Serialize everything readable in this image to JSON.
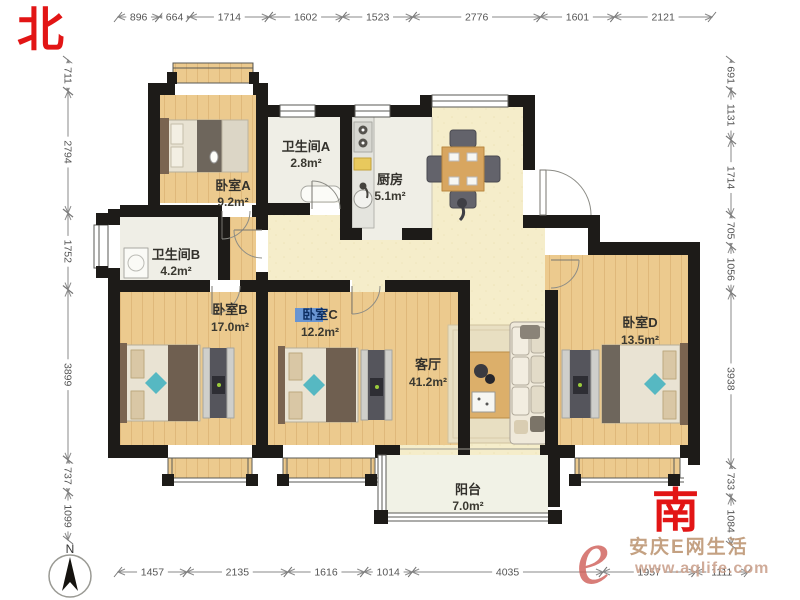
{
  "directions": {
    "north": "北",
    "south": "南"
  },
  "compass": {
    "label": "N"
  },
  "watermark": {
    "logo": "e",
    "site_name": "安庆E网生活",
    "url": "www.aqlife.com"
  },
  "rooms": {
    "bedroomA": {
      "name": "卧室A",
      "area": "9.2m²"
    },
    "bathroomA": {
      "name": "卫生间A",
      "area": "2.8m²"
    },
    "kitchen": {
      "name": "厨房",
      "area": "5.1m²"
    },
    "bathroomB": {
      "name": "卫生间B",
      "area": "4.2m²"
    },
    "bedroomB": {
      "name": "卧室B",
      "area": "17.0m²"
    },
    "bedroomC": {
      "name_highlight": "卧室",
      "name_rest": "C",
      "area": "12.2m²"
    },
    "living": {
      "name": "客厅",
      "area": "41.2m²"
    },
    "bedroomD": {
      "name": "卧室D",
      "area": "13.5m²"
    },
    "balcony": {
      "name": "阳台",
      "area": "7.0m²"
    }
  },
  "dimensions": {
    "top": {
      "values": [
        896,
        664,
        1714,
        1602,
        1523,
        2776,
        1601,
        2121
      ]
    },
    "bottom": {
      "values": [
        1457,
        2135,
        1616,
        1014,
        4035,
        1957,
        1111
      ]
    },
    "left": {
      "values": [
        711,
        2794,
        1752,
        3899,
        737,
        1099
      ]
    },
    "right": {
      "values": [
        691,
        1131,
        1714,
        705,
        1056,
        3938,
        733,
        1084
      ]
    }
  },
  "colors": {
    "wall": "#1d1b18",
    "wood_floor": "#ecca8e",
    "living_floor": "#f5edca",
    "tile_floor": "#efeee6",
    "balcony_floor": "#f1f2e6",
    "accent_teal": "#56b8c2",
    "highlight_blue": "#5b8fd9",
    "direction_red": "#e21515",
    "dimension_gray": "#8a8a8a"
  }
}
